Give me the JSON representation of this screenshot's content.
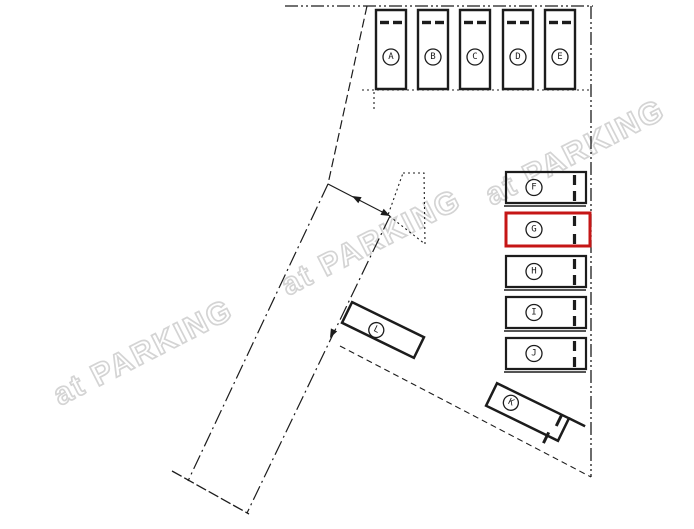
{
  "document": {
    "kind": "parking-layout-plan",
    "background": "#ffffff"
  },
  "watermark": {
    "text": "at PARKING",
    "color": "#d4d4d4"
  },
  "colors": {
    "line": "#1c1c1c",
    "highlight": "#c51616"
  },
  "selected_stall": "G",
  "stalls": [
    {
      "label": "A"
    },
    {
      "label": "B"
    },
    {
      "label": "C"
    },
    {
      "label": "D"
    },
    {
      "label": "E"
    },
    {
      "label": "F"
    },
    {
      "label": "G",
      "highlighted": true
    },
    {
      "label": "H"
    },
    {
      "label": "I"
    },
    {
      "label": "J"
    },
    {
      "label": "L"
    },
    {
      "label": "K"
    }
  ]
}
